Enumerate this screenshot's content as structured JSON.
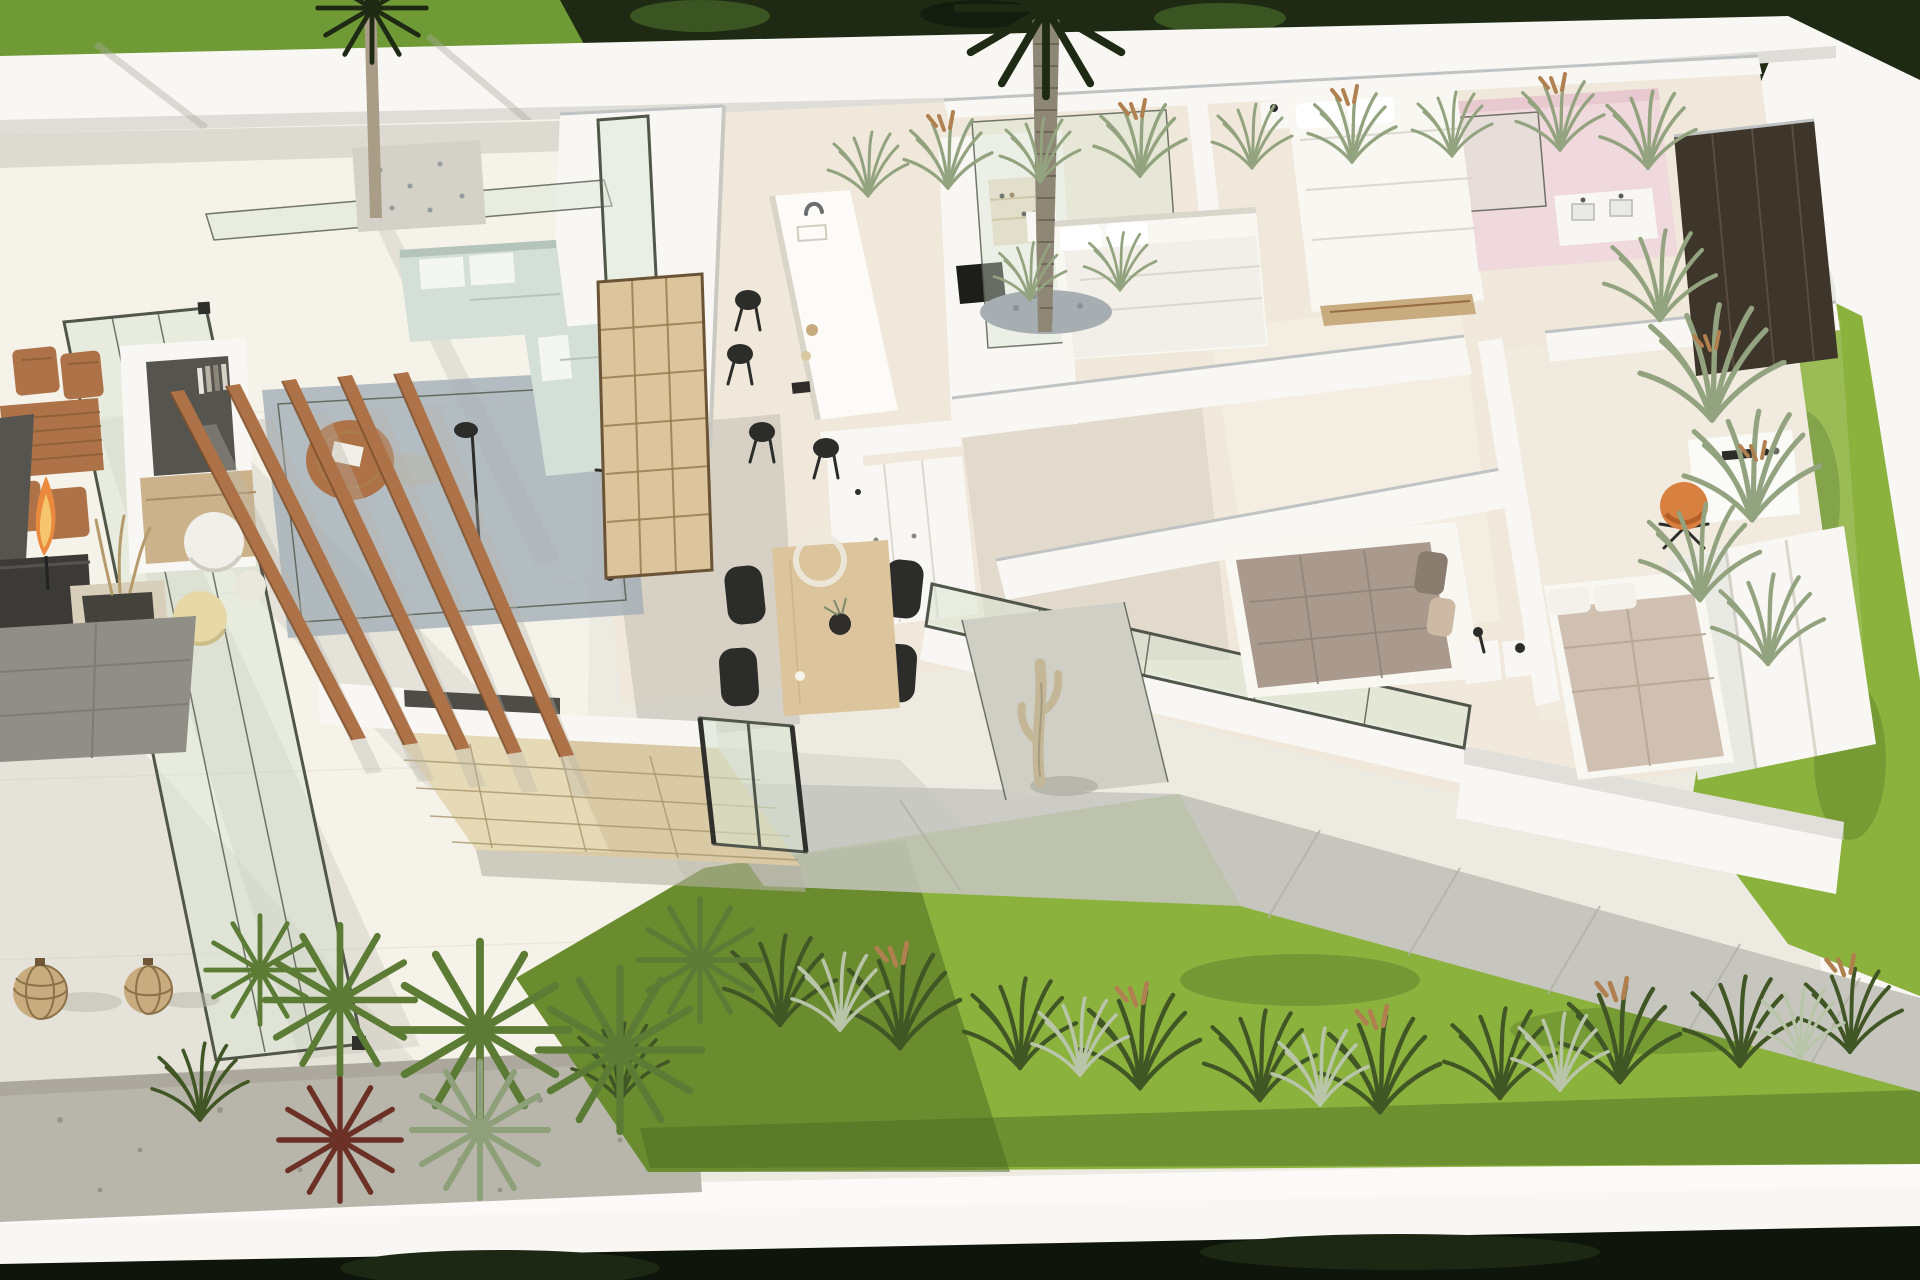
{
  "scene": {
    "kind": "architectural-3d-floorplan-render",
    "view": "aerial cutaway of single-storey villa with furnished interior, glazed living wing, terrace, pergola slats, central palm courtyard, three bedrooms, pink bathroom and wrap-around walled garden"
  },
  "palette": {
    "paving": "#edeae1",
    "paving_bright": "#f5f2e9",
    "wall_white": "#f8f7f3",
    "wall_shade": "#c9c8c1",
    "interior_floor": "#f0e9db",
    "glass": "#d7e4d2",
    "glass_frame": "#51564b",
    "grass_bright": "#8cb23e",
    "grass_mid": "#6f9a35",
    "grass_dark": "#48661f",
    "foliage_dark": "#1e2a13",
    "gravel": "#b8b5ab",
    "pebble": "#a7aeb2",
    "path_gray": "#c6c6bf",
    "stone": "#d9caa5",
    "stone_light": "#eadfbe",
    "wood": "#ad7247",
    "wood_dark": "#7c4f2b",
    "wood_light": "#dcc49c",
    "sofa": "#d4dfd7",
    "rug": "#a2aeb7",
    "black": "#2c2c2a",
    "dark_unit": "#3e352b",
    "bed_white": "#f8f7f2",
    "bed_gray": "#a99a8d",
    "bed_beige": "#cfc0b1",
    "pink": "#f0d9dd",
    "pink_deep": "#e8c9cf",
    "orange": "#d8803f",
    "flame": "#e98a3e",
    "flame_core": "#f6c66f",
    "cactus": "#c3b798",
    "tan": "#c8ab7e",
    "trunk": "#a99d88",
    "palm_trunk": "#8f8775",
    "palm_ring": "#6f6859",
    "tuft_sage": "#93a37f",
    "tuft_dark": "#415625",
    "tuft_silver": "#b9c5a9",
    "seed": "#b08050",
    "fan_green": "#5c7c35",
    "plant_red": "#6b3026",
    "agave": "#8ea07a",
    "counter_dark": "#56544e",
    "mat_gray": "#908e86",
    "console_wood": "#cbb28b",
    "tv_gray": "#55544e",
    "night_dark": "#10150c"
  },
  "objects": [
    {
      "name": "perimeter-wall",
      "color": "wall_white"
    },
    {
      "name": "outside-hedge",
      "color": "foliage_dark"
    },
    {
      "name": "terrace-paving",
      "color": "paving_bright"
    },
    {
      "name": "gravel-bed",
      "color": "gravel"
    },
    {
      "name": "bottom-lawn",
      "color": "grass_bright"
    },
    {
      "name": "right-lawn-strip",
      "color": "grass_bright"
    },
    {
      "name": "courtyard-lawn",
      "color": "grass_mid"
    },
    {
      "name": "garden-path",
      "color": "path_gray"
    },
    {
      "name": "stone-feature-wall",
      "color": "stone"
    },
    {
      "name": "glass-enclosure",
      "color": "glass"
    },
    {
      "name": "pergola-slats",
      "color": "wood"
    },
    {
      "name": "outdoor-dining-set",
      "color": "wood"
    },
    {
      "name": "fire-torch",
      "color": "flame"
    },
    {
      "name": "outdoor-planter",
      "color": "tan"
    },
    {
      "name": "rattan-lanterns",
      "color": "tan"
    },
    {
      "name": "tv-wall-unit",
      "color": "tv_gray"
    },
    {
      "name": "bookshelf",
      "color": "wood_light"
    },
    {
      "name": "sofa-l-shape",
      "color": "sofa"
    },
    {
      "name": "area-rug",
      "color": "rug"
    },
    {
      "name": "round-coffee-table",
      "color": "wood"
    },
    {
      "name": "poufs",
      "color": "bed_white"
    },
    {
      "name": "kitchen-island",
      "color": "wall_white"
    },
    {
      "name": "bar-stools",
      "color": "black"
    },
    {
      "name": "coffee-niche",
      "color": "tan"
    },
    {
      "name": "dining-table",
      "color": "wood_light"
    },
    {
      "name": "dining-chairs",
      "color": "black"
    },
    {
      "name": "ring-pendant-lamp",
      "color": "wall_white"
    },
    {
      "name": "palm-tree",
      "color": "palm_trunk"
    },
    {
      "name": "courtyard-tree",
      "color": "trunk"
    },
    {
      "name": "cactus-sculpture",
      "color": "cactus"
    },
    {
      "name": "bed-double-white-a",
      "color": "bed_white"
    },
    {
      "name": "bed-double-white-b",
      "color": "bed_white"
    },
    {
      "name": "bed-gray-quilt",
      "color": "bed_gray"
    },
    {
      "name": "bed-beige-duvet",
      "color": "bed_beige"
    },
    {
      "name": "pink-bathroom",
      "color": "pink"
    },
    {
      "name": "vanity-unit",
      "color": "wall_white"
    },
    {
      "name": "dark-wardrobe",
      "color": "dark_unit"
    },
    {
      "name": "white-wardrobe",
      "color": "wall_white"
    },
    {
      "name": "desk",
      "color": "wall_white"
    },
    {
      "name": "orange-desk-chair",
      "color": "orange"
    },
    {
      "name": "ornamental-grasses",
      "color": "tuft_sage"
    },
    {
      "name": "fan-palms",
      "color": "fan_green"
    }
  ]
}
